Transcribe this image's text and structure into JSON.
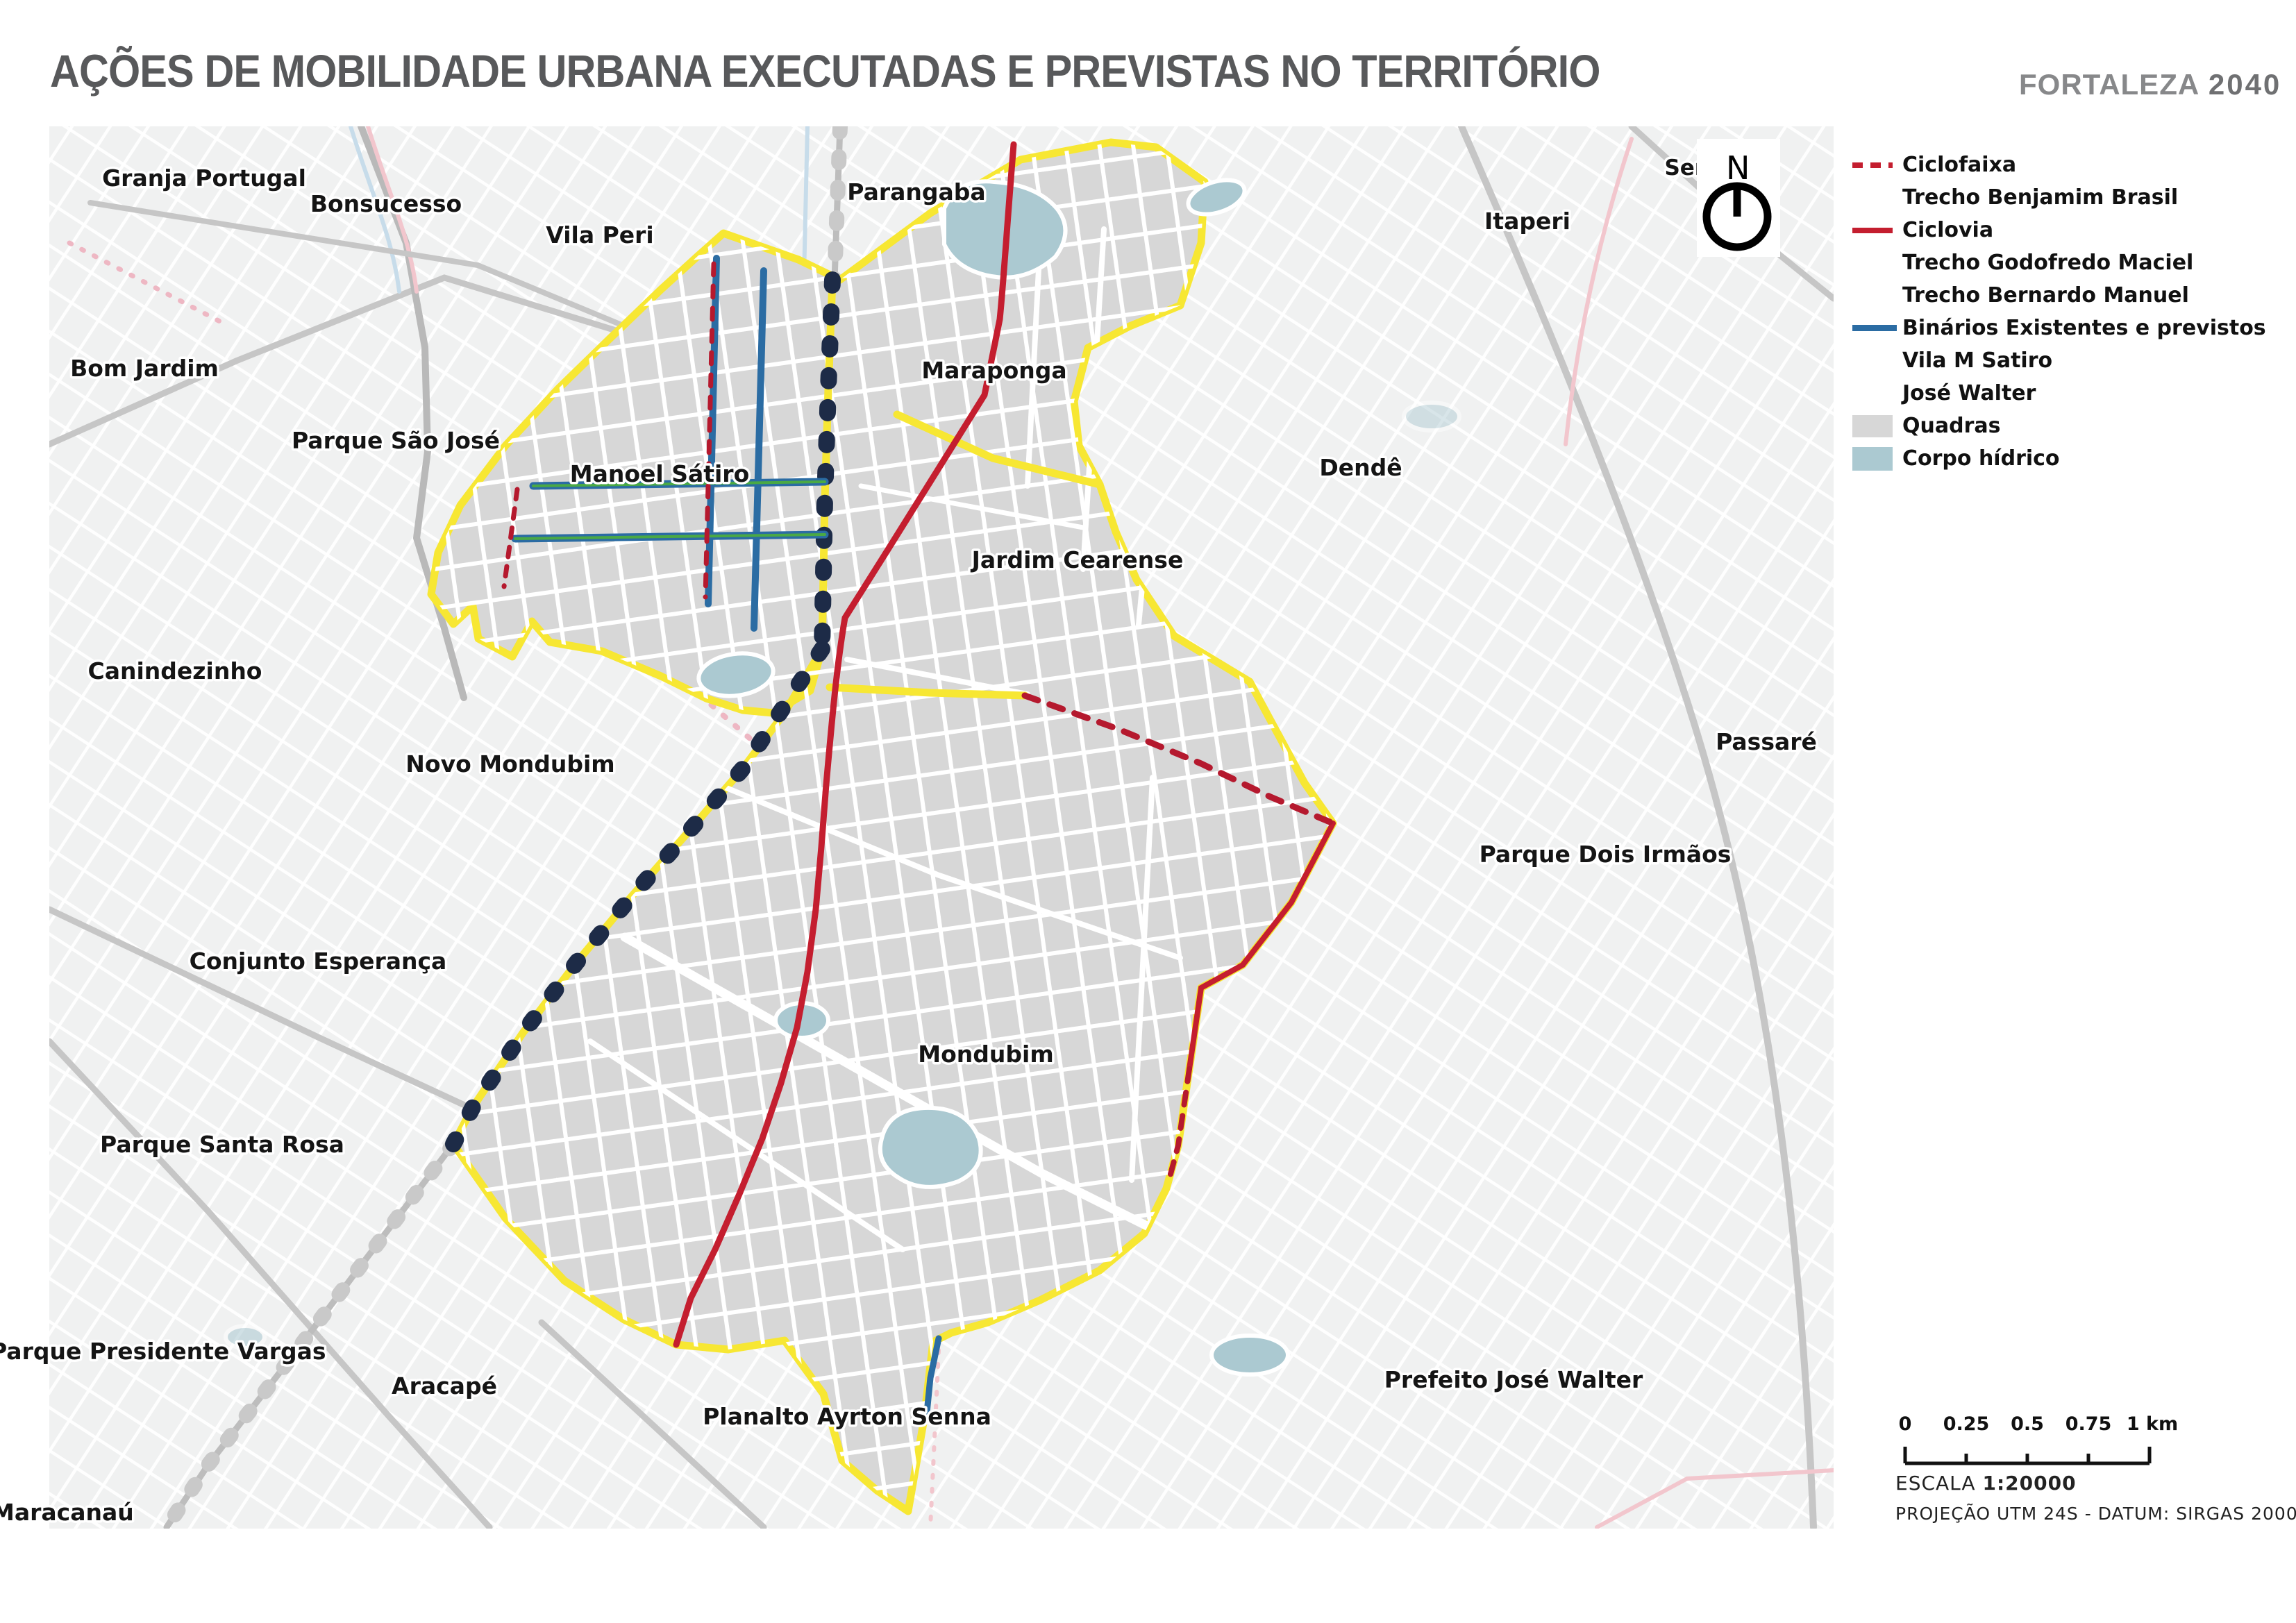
{
  "title": "AÇÕES DE MOBILIDADE URBANA EXECUTADAS E PREVISTAS NO TERRITÓRIO",
  "brand": {
    "name": "FORTALEZA",
    "year": "2040"
  },
  "legend": {
    "items": [
      {
        "label": "Ciclofaixa",
        "swatch": "dash-red"
      },
      {
        "label": "Trecho Benjamim Brasil",
        "swatch": "none"
      },
      {
        "label": "Ciclovia",
        "swatch": "solid-red"
      },
      {
        "label": "Trecho Godofredo Maciel",
        "swatch": "none"
      },
      {
        "label": "Trecho Bernardo Manuel",
        "swatch": "none"
      },
      {
        "label": "Binários Existentes e previstos",
        "swatch": "solid-blue"
      },
      {
        "label": "Vila M Satiro",
        "swatch": "none"
      },
      {
        "label": "José Walter",
        "swatch": "none"
      },
      {
        "label": "Quadras",
        "swatch": "fill-gray"
      },
      {
        "label": "Corpo hídrico",
        "swatch": "fill-blue"
      }
    ]
  },
  "map": {
    "labels": [
      {
        "text": "Granja Portugal"
      },
      {
        "text": "Bonsucesso"
      },
      {
        "text": "Vila Peri"
      },
      {
        "text": "Parangaba"
      },
      {
        "text": "Itaperi"
      },
      {
        "text": "Bom Jardim"
      },
      {
        "text": "Parque São José"
      },
      {
        "text": "Manoel Sátiro"
      },
      {
        "text": "Maraponga"
      },
      {
        "text": "Dendê"
      },
      {
        "text": "Jardim Cearense"
      },
      {
        "text": "Canindezinho"
      },
      {
        "text": "Novo Mondubim"
      },
      {
        "text": "Passaré"
      },
      {
        "text": "Parque Dois Irmãos"
      },
      {
        "text": "Conjunto Esperança"
      },
      {
        "text": "Mondubim"
      },
      {
        "text": "Parque Santa Rosa"
      },
      {
        "text": "Parque Presidente Vargas"
      },
      {
        "text": "Aracapé"
      },
      {
        "text": "Planalto Ayrton Senna"
      },
      {
        "text": "Prefeito José Walter"
      },
      {
        "text": "Maracanaú"
      },
      {
        "text": "Serri"
      }
    ],
    "compass": {
      "north": "N"
    }
  },
  "scale_bar": {
    "ticks": [
      "0",
      "0.25",
      "0.5",
      "0.75",
      "1 km"
    ],
    "scale_label": "ESCALA",
    "scale_value": "1:20000",
    "projection": "PROJEÇÃO UTM 24S - DATUM: SIRGAS 2000"
  },
  "colors": {
    "boundary_yellow": "#f7e733",
    "ciclovia_red": "#c41e2f",
    "ciclofaixa_red": "#b5192e",
    "binario_blue": "#2b6ca3",
    "binario_green": "#4aa945",
    "quadras_gray": "#d7d7d7",
    "water_blue": "#abc9d1",
    "title_gray": "#58595b",
    "brand_gray": "#87888a",
    "map_bg": "#f0f1f1"
  }
}
